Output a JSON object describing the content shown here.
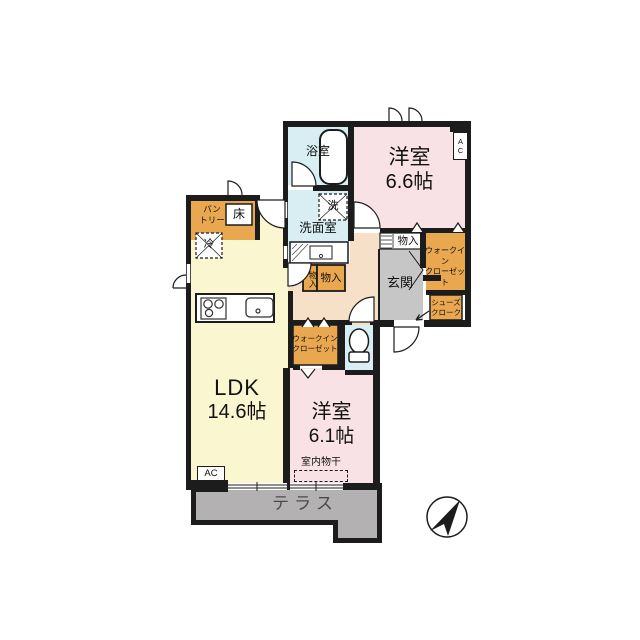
{
  "colors": {
    "wall": "#1c1c1c",
    "room_bath": "#d8eef2",
    "room_bedroom": "#f9e2e6",
    "room_ldk": "#faf6cf",
    "room_hall": "#f7e0c8",
    "room_closet": "#e9a74f",
    "room_entrance": "#c6c6c6",
    "terrace": "#b3b1b1"
  },
  "rooms": {
    "bath": "浴室",
    "washroom": "洗面室",
    "bedroom1": {
      "name": "洋室",
      "size": "6.6帖"
    },
    "bedroom2": {
      "name": "洋室",
      "size": "6.1帖"
    },
    "ldk": {
      "name": "LDK",
      "size": "14.6帖"
    },
    "entrance": "玄関",
    "terrace": "テラス",
    "pantry": {
      "line1": "パン",
      "line2": "トリー"
    },
    "toko": "床",
    "walkin_closet_main": {
      "line1": "ウォークイン",
      "line2": "クローゼット"
    },
    "walkin_closet_2": {
      "line1": "ウォークイン",
      "line2": "クローゼット"
    },
    "shoes_cloak": {
      "line1": "シューズ",
      "line2": "クローク"
    },
    "storage_small": "物入",
    "storage_hall": "物入",
    "storage_entrance": "物入"
  },
  "fixtures": {
    "refrigerator": "冷",
    "washer": "洗",
    "indoor_drying": "室内物干",
    "ac_ldk": "AC",
    "ac_bedroom": "AC"
  }
}
